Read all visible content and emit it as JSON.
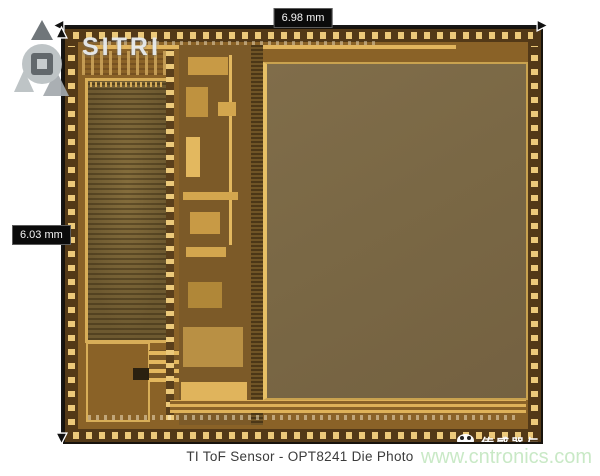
{
  "figure": {
    "width_label": "6.98 mm",
    "height_label": "6.03 mm",
    "caption": "TI ToF Sensor - OPT8241 Die Photo"
  },
  "watermarks": {
    "institute_logo": "SITRI",
    "website": "www.cntronics.com",
    "cn_banner": "传感器与科"
  },
  "colors": {
    "die_gold": "#b98e3e",
    "pad_gold": "#ecc97a",
    "pixel_array": "#7b6946",
    "dimension_label_bg": "#0b0b0b",
    "dimension_label_text": "#f5f5f5",
    "watermark_green": "#c9e9c6",
    "caption_text": "#3b3b3b"
  },
  "icons": {
    "sitri_emblem": "triangles-and-ring-logo",
    "panda_mascot": "white-panda-face",
    "dimension_arrows": "double-headed-arrows"
  }
}
